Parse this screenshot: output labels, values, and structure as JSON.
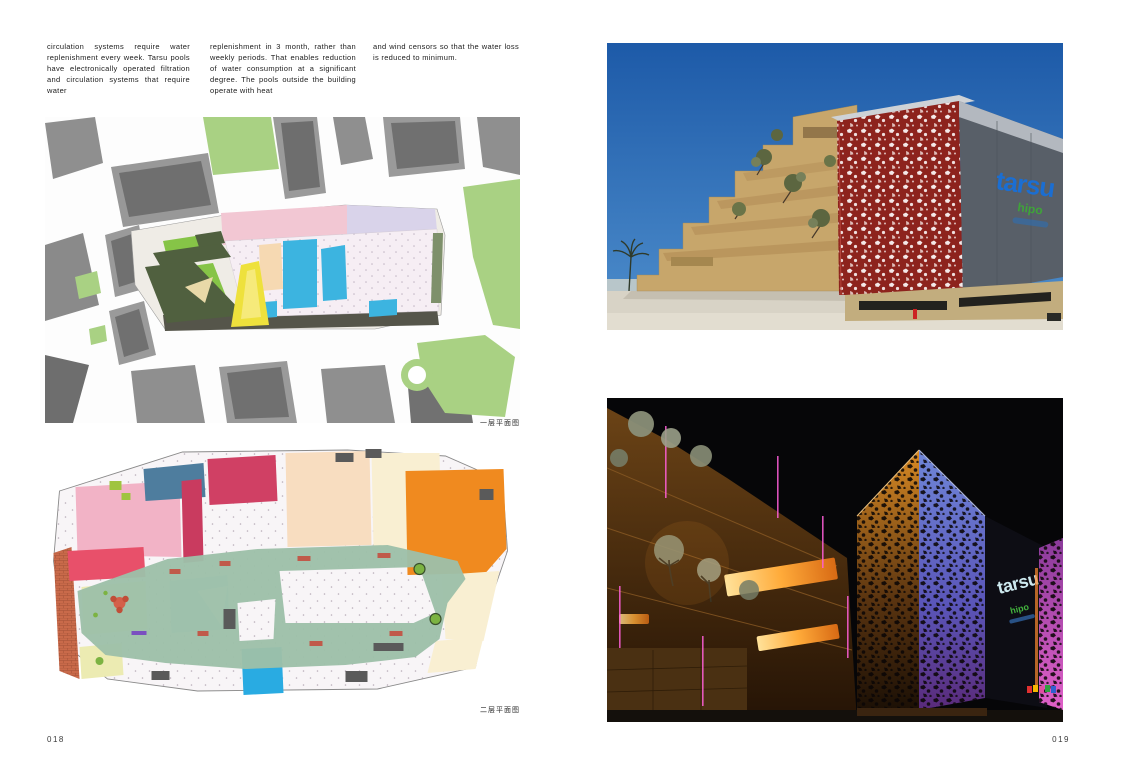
{
  "left_page": {
    "page_number": "018",
    "body_columns": [
      {
        "text": "circulation systems require water replenishment every week. Tarsu pools have electronically operated filtration and circulation systems that require water"
      },
      {
        "text": "replenishment in 3 month, rather than weekly periods. That enables reduction of water consumption at a significant degree. The pools outside the building operate with heat"
      },
      {
        "text": "and wind censors so that the water loss is reduced to minimum."
      }
    ],
    "figures": [
      {
        "name": "site-plan",
        "caption": "一层平面图"
      },
      {
        "name": "second-floor-plan",
        "caption": "二层平面图"
      }
    ]
  },
  "right_page": {
    "page_number": "019",
    "photos": [
      {
        "name": "day-facade-photo",
        "sign": {
          "line1": "tarsu",
          "line2": "hipo"
        }
      },
      {
        "name": "night-facade-photo",
        "sign": {
          "line1": "tarsu",
          "line2": "hipo"
        }
      }
    ]
  },
  "colors": {
    "logo_blue": "#1b6ed2",
    "logo_green": "#3fa33a",
    "facade_red": "#8d231d",
    "map_pool_blue": "#3cb4e0",
    "plan_loop_green": "#9dc0a9",
    "plan_orange": "#f08a1f",
    "map_green": "#a9d183"
  }
}
